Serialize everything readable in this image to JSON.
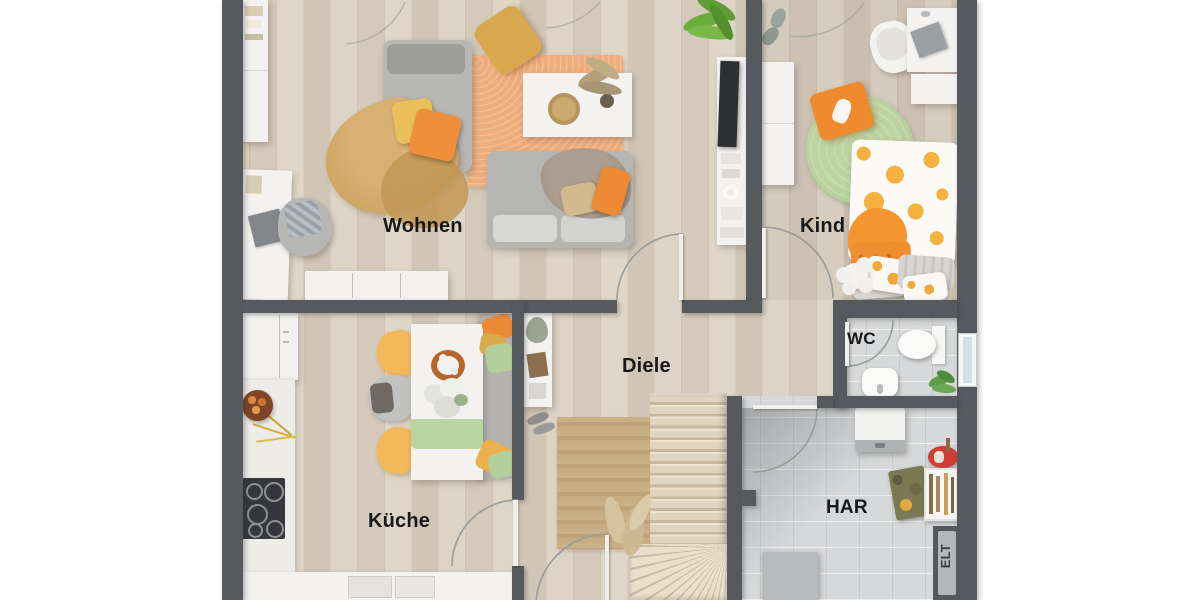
{
  "rooms": {
    "wohnen": {
      "label": "Wohnen"
    },
    "kind": {
      "label": "Kind"
    },
    "diele": {
      "label": "Diele"
    },
    "kueche": {
      "label": "Küche"
    },
    "wc": {
      "label": "WC"
    },
    "har": {
      "label": "HAR"
    },
    "elt": {
      "label": "ELT"
    }
  },
  "palette": {
    "wall": "#565a5e",
    "wood_floor": "#d9cfc1",
    "tile_floor": "#d6d7d8",
    "accent_orange": "#ee8f33",
    "accent_yellow": "#e9bd5b",
    "accent_green": "#b6cf9b",
    "rug_orange": "#efae80",
    "rug_green": "#b7cf9b",
    "rug_jute": "#c5ab81",
    "label_color": "#17181a"
  }
}
